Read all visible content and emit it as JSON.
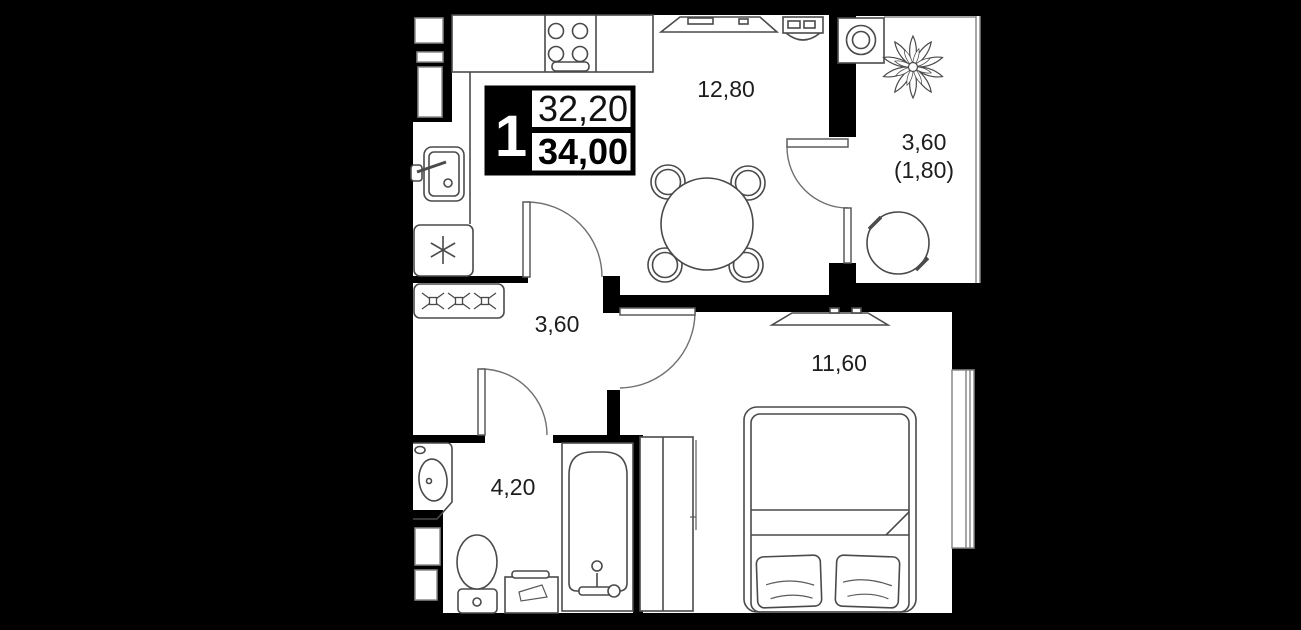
{
  "unit_card": {
    "rooms_count": "1",
    "area_living": "32,20",
    "area_total": "34,00"
  },
  "room_labels": {
    "kitchen_living": "12,80",
    "balcony_area": "3,60",
    "balcony_area_coefficient": "(1,80)",
    "hallway": "3,60",
    "bedroom": "11,60",
    "bathroom": "4,20"
  },
  "colors": {
    "background": "#000000",
    "walls": "#000000",
    "floor": "#ffffff",
    "fixture_line": "#4a4a4a",
    "glazing_line": "#8a8a8a",
    "text": "#1d1d1f",
    "card_highlight_bg": "#000000",
    "card_text_inverse": "#ffffff"
  }
}
